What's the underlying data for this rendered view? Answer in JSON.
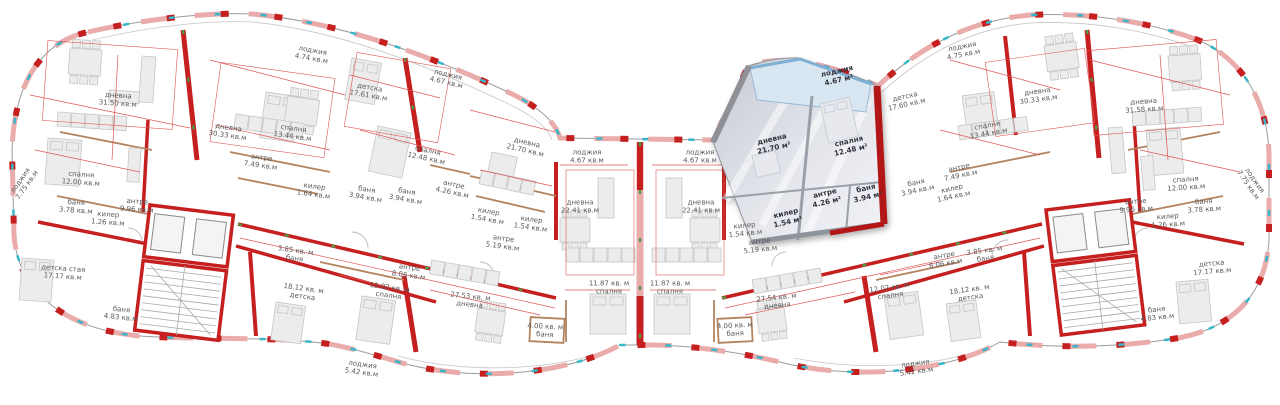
{
  "plan": {
    "kind": "apartment-floor-plan",
    "language": "bg/ru",
    "area_unit_regular": "кв.м",
    "area_unit_selected": "м²"
  },
  "colors": {
    "wall-red": "#c51f1f",
    "wall-pink": "#eaabab",
    "wall-dark": "#8f939b",
    "hl-red": "#b21616",
    "dim-red": "#e05555",
    "tick-green": "#46a046",
    "window-cyan": "#35b6c9",
    "furniture-grey": "#ececec",
    "furniture-border": "#c6c6c6",
    "outline-grey": "#9b9b9b",
    "glass-blue": "#d8e6f2",
    "label-grey": "#5a5a5a"
  },
  "selected_unit": {
    "rooms": [
      "лоджия 4.67 м²",
      "дневна 21.70 м²",
      "спалня 12.48 м²",
      "антре 4.26 м²",
      "баня 3.94 м²",
      "килер 1.54 м²"
    ]
  },
  "rooms": [
    {
      "name": "лоджия",
      "area": "7.75 кв.м",
      "x": 24,
      "y": 183,
      "rot": -55,
      "hl": false
    },
    {
      "name": "дневна",
      "area": "31.50 кв.м",
      "x": 118,
      "y": 100,
      "rot": 4,
      "hl": false
    },
    {
      "name": "спалня",
      "area": "12.00 кв.м",
      "x": 81,
      "y": 179,
      "rot": 4,
      "hl": false
    },
    {
      "name": "баня",
      "area": "3.78 кв.м",
      "x": 76,
      "y": 207,
      "rot": 4,
      "hl": false
    },
    {
      "name": "килер",
      "area": "1.26 кв.м",
      "x": 108,
      "y": 219,
      "rot": 4,
      "hl": false
    },
    {
      "name": "антре",
      "area": "9.96 кв.м",
      "x": 137,
      "y": 206,
      "rot": 4,
      "hl": false
    },
    {
      "name": "детска стая",
      "area": "17.17 кв.м",
      "x": 63,
      "y": 273,
      "rot": 4,
      "hl": false
    },
    {
      "name": "баня",
      "area": "4.83 кв.м",
      "x": 121,
      "y": 314,
      "rot": 6,
      "hl": false
    },
    {
      "name": "дневна",
      "area": "30.33 кв.м",
      "x": 228,
      "y": 132,
      "rot": 8,
      "hl": false
    },
    {
      "name": "спалня",
      "area": "13.44 кв.м",
      "x": 293,
      "y": 133,
      "rot": 8,
      "hl": false
    },
    {
      "name": "антре",
      "area": "7.49 кв.м",
      "x": 261,
      "y": 162,
      "rot": 8,
      "hl": false
    },
    {
      "name": "килер",
      "area": "1.64 кв.м",
      "x": 314,
      "y": 191,
      "rot": 8,
      "hl": false
    },
    {
      "name": "лоджия",
      "area": "4.74 кв.м",
      "x": 312,
      "y": 55,
      "rot": 10,
      "hl": false
    },
    {
      "name": "детска",
      "area": "17.61 кв.м",
      "x": 369,
      "y": 92,
      "rot": 10,
      "hl": false
    },
    {
      "name": "баня",
      "area": "3.94 кв.м",
      "x": 366,
      "y": 194,
      "rot": 10,
      "hl": false
    },
    {
      "name": "баня",
      "area": "3.94 кв.м",
      "x": 406,
      "y": 196,
      "rot": 10,
      "hl": false
    },
    {
      "name": "спалня",
      "area": "12.48 кв.м",
      "x": 427,
      "y": 155,
      "rot": 12,
      "hl": false
    },
    {
      "name": "антре",
      "area": "4.26 кв.м",
      "x": 453,
      "y": 189,
      "rot": 12,
      "hl": false
    },
    {
      "name": "лоджия",
      "area": "4.67 кв.м",
      "x": 447,
      "y": 79,
      "rot": 13,
      "hl": false
    },
    {
      "name": "дневна",
      "area": "21.70 кв.м",
      "x": 526,
      "y": 147,
      "rot": 13,
      "hl": false
    },
    {
      "name": "килер",
      "area": "1.54 кв.м",
      "x": 488,
      "y": 216,
      "rot": 10,
      "hl": false
    },
    {
      "name": "килер",
      "area": "1.54 кв.м",
      "x": 531,
      "y": 224,
      "rot": 8,
      "hl": false
    },
    {
      "name": "антре",
      "area": "5.19 кв.м",
      "x": 503,
      "y": 243,
      "rot": 8,
      "hl": false
    },
    {
      "name": "лоджия",
      "area": "4.67 кв.м",
      "x": 587,
      "y": 157,
      "rot": 0,
      "hl": false
    },
    {
      "name": "дневна",
      "area": "22.41 кв.м",
      "x": 580,
      "y": 207,
      "rot": 0,
      "hl": false
    },
    {
      "name": "антре",
      "area": "8.06 кв.м",
      "x": 409,
      "y": 272,
      "rot": 8,
      "hl": false
    },
    {
      "name": "12.02 кв. м",
      "area": "спалня",
      "x": 389,
      "y": 292,
      "rot": 8,
      "hl": false
    },
    {
      "name": "27.53 кв. м",
      "area": "дневна",
      "x": 470,
      "y": 301,
      "rot": 6,
      "hl": false
    },
    {
      "name": "4.00 кв. м",
      "area": "баня",
      "x": 545,
      "y": 331,
      "rot": 3,
      "hl": false
    },
    {
      "name": "11.87 кв. м",
      "area": "спалня",
      "x": 609,
      "y": 288,
      "rot": 0,
      "hl": false
    },
    {
      "name": "лоджия",
      "area": "5.42 кв.м",
      "x": 362,
      "y": 369,
      "rot": 8,
      "hl": false
    },
    {
      "name": "3.85 кв. м",
      "area": "баня",
      "x": 295,
      "y": 255,
      "rot": 8,
      "hl": false
    },
    {
      "name": "18.12 кв. м",
      "area": "детска",
      "x": 303,
      "y": 293,
      "rot": 8,
      "hl": false
    },
    {
      "name": "лоджия",
      "area": "4.67 кв.м",
      "x": 700,
      "y": 157,
      "rot": 0,
      "hl": false
    },
    {
      "name": "дневна",
      "area": "22.41 кв.м",
      "x": 701,
      "y": 207,
      "rot": 0,
      "hl": false
    },
    {
      "name": "килер",
      "area": "1.54 кв.м",
      "x": 745,
      "y": 230,
      "rot": -6,
      "hl": false
    },
    {
      "name": "антре",
      "area": "5.19 кв.м",
      "x": 760,
      "y": 246,
      "rot": -6,
      "hl": false
    },
    {
      "name": "11.87 кв. м",
      "area": "спалня",
      "x": 670,
      "y": 288,
      "rot": 0,
      "hl": false
    },
    {
      "name": "4.00 кв. м",
      "area": "баня",
      "x": 735,
      "y": 330,
      "rot": -3,
      "hl": false
    },
    {
      "name": "27.54 кв. м",
      "area": "дневна",
      "x": 777,
      "y": 302,
      "rot": -6,
      "hl": false
    },
    {
      "name": "антре",
      "area": "8.06 кв.м",
      "x": 945,
      "y": 260,
      "rot": -10,
      "hl": false
    },
    {
      "name": "12.02 кв. м",
      "area": "спалня",
      "x": 890,
      "y": 292,
      "rot": -8,
      "hl": false
    },
    {
      "name": "лоджия",
      "area": "5.42 кв.м",
      "x": 916,
      "y": 368,
      "rot": -8,
      "hl": false
    },
    {
      "name": "3.85 кв. м",
      "area": "баня",
      "x": 985,
      "y": 255,
      "rot": -8,
      "hl": false
    },
    {
      "name": "18.12 кв. м",
      "area": "детска",
      "x": 970,
      "y": 294,
      "rot": -8,
      "hl": false
    },
    {
      "name": "лоджия",
      "area": "4.67 м²",
      "x": 838,
      "y": 76,
      "rot": -13,
      "hl": true
    },
    {
      "name": "дневна",
      "area": "21.70 м²",
      "x": 773,
      "y": 144,
      "rot": -13,
      "hl": true
    },
    {
      "name": "спалня",
      "area": "12.48 м²",
      "x": 850,
      "y": 146,
      "rot": -13,
      "hl": true
    },
    {
      "name": "антре",
      "area": "4.26 м²",
      "x": 826,
      "y": 198,
      "rot": -13,
      "hl": true
    },
    {
      "name": "баня",
      "area": "3.94 м²",
      "x": 867,
      "y": 193,
      "rot": -13,
      "hl": true
    },
    {
      "name": "килер",
      "area": "1.54 м²",
      "x": 787,
      "y": 218,
      "rot": -13,
      "hl": true
    },
    {
      "name": "детска",
      "area": "17.60 кв.м",
      "x": 906,
      "y": 101,
      "rot": -13,
      "hl": false
    },
    {
      "name": "лоджия",
      "area": "4.75 кв.м",
      "x": 963,
      "y": 51,
      "rot": -11,
      "hl": false
    },
    {
      "name": "антре",
      "area": "7.49 кв.м",
      "x": 960,
      "y": 172,
      "rot": -12,
      "hl": false
    },
    {
      "name": "баня",
      "area": "3.94 кв.м",
      "x": 917,
      "y": 187,
      "rot": -12,
      "hl": false
    },
    {
      "name": "килер",
      "area": "1.64 кв.м",
      "x": 953,
      "y": 193,
      "rot": -12,
      "hl": false
    },
    {
      "name": "спалня",
      "area": "13.44 кв.м",
      "x": 988,
      "y": 130,
      "rot": -10,
      "hl": false
    },
    {
      "name": "дневна",
      "area": "30.33 кв.м",
      "x": 1038,
      "y": 96,
      "rot": -8,
      "hl": false
    },
    {
      "name": "дневна",
      "area": "31.58 кв.м",
      "x": 1144,
      "y": 106,
      "rot": -4,
      "hl": false
    },
    {
      "name": "спалня",
      "area": "12.00 кв.м",
      "x": 1186,
      "y": 184,
      "rot": -4,
      "hl": false
    },
    {
      "name": "баня",
      "area": "3.78 кв.м",
      "x": 1204,
      "y": 206,
      "rot": -4,
      "hl": false
    },
    {
      "name": "килер",
      "area": "1.26 кв.м",
      "x": 1168,
      "y": 221,
      "rot": -4,
      "hl": false
    },
    {
      "name": "антре",
      "area": "9.96 кв.м",
      "x": 1136,
      "y": 206,
      "rot": -4,
      "hl": false
    },
    {
      "name": "лоджия",
      "area": "7.75 кв.м",
      "x": 1251,
      "y": 183,
      "rot": 55,
      "hl": false
    },
    {
      "name": "детска",
      "area": "17.17 кв.м",
      "x": 1212,
      "y": 268,
      "rot": -5,
      "hl": false
    },
    {
      "name": "баня",
      "area": "4.83 кв.м",
      "x": 1157,
      "y": 314,
      "rot": -6,
      "hl": false
    }
  ]
}
